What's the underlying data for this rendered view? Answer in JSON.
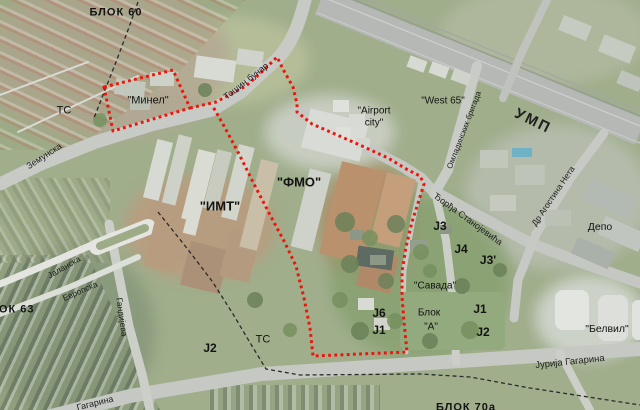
{
  "map_type": "aerial-satellite plan of Novi Beograd blocks with marked zones",
  "area_labels": [
    {
      "text": "БЛОК 60"
    },
    {
      "text": "ТС"
    },
    {
      "text": "\"Минел\""
    },
    {
      "text": "\"ИМТ\""
    },
    {
      "text": "\"ФМО\""
    },
    {
      "text": "\"Airport\ncity\""
    },
    {
      "text": "\"West 65\""
    },
    {
      "text": "БЛОК 63"
    },
    {
      "text": "J2"
    },
    {
      "text": "ТС"
    },
    {
      "text": "J6"
    },
    {
      "text": "J1"
    },
    {
      "text": "\"Савада\""
    },
    {
      "text": "Блок"
    },
    {
      "text": "\"А\""
    },
    {
      "text": "J1"
    },
    {
      "text": "J2"
    },
    {
      "text": "J3"
    },
    {
      "text": "J4"
    },
    {
      "text": "J3'"
    },
    {
      "text": "Депо"
    },
    {
      "text": "\"Белвил\""
    },
    {
      "text": "БЛОК 70а"
    }
  ],
  "street_labels": [
    {
      "text": "Земунска"
    },
    {
      "text": "Тошин бунар"
    },
    {
      "text": "Јаланска"
    },
    {
      "text": "Европска"
    },
    {
      "text": "Гандијева"
    },
    {
      "text": "Гагарина"
    },
    {
      "text": "Јурија Гагарина"
    },
    {
      "text": "Ђорђа Станојевића"
    },
    {
      "text": "Др Агостина Нета"
    },
    {
      "text": "Омладинских бригада"
    },
    {
      "text": "УМП"
    }
  ],
  "overlay": {
    "red_boundary_color": "#ee1409",
    "black_dash_color": "#2b2b2b",
    "road_color": "#c6c8c3",
    "highway_color": "#b6b8b6"
  }
}
